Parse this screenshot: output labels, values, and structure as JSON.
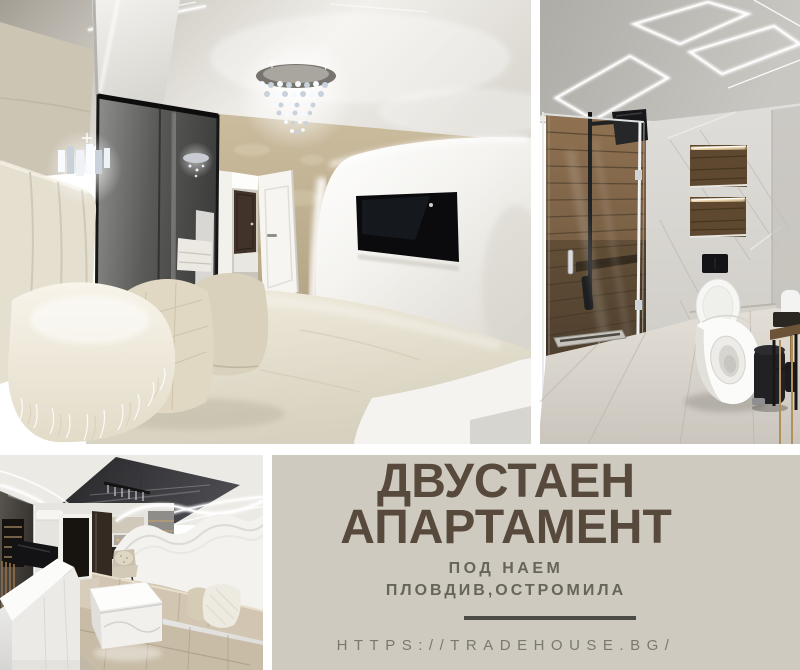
{
  "caption": {
    "title_line1": "ДВУСТАЕН",
    "title_line2": "АПАРТАМЕНТ",
    "subtitle": "ПОД НАЕМ",
    "location": "ПЛОВДИВ,ОСТРОМИЛА",
    "website": "HTTPS://TRADEHOUSE.BG/"
  },
  "theme": {
    "panel_bg": "#cecabf",
    "title_color": "#574a3c",
    "subtitle_color": "#67645c",
    "url_color": "#7b786f",
    "divider_color": "#4b4a45",
    "frame_bg": "#ffffff"
  }
}
